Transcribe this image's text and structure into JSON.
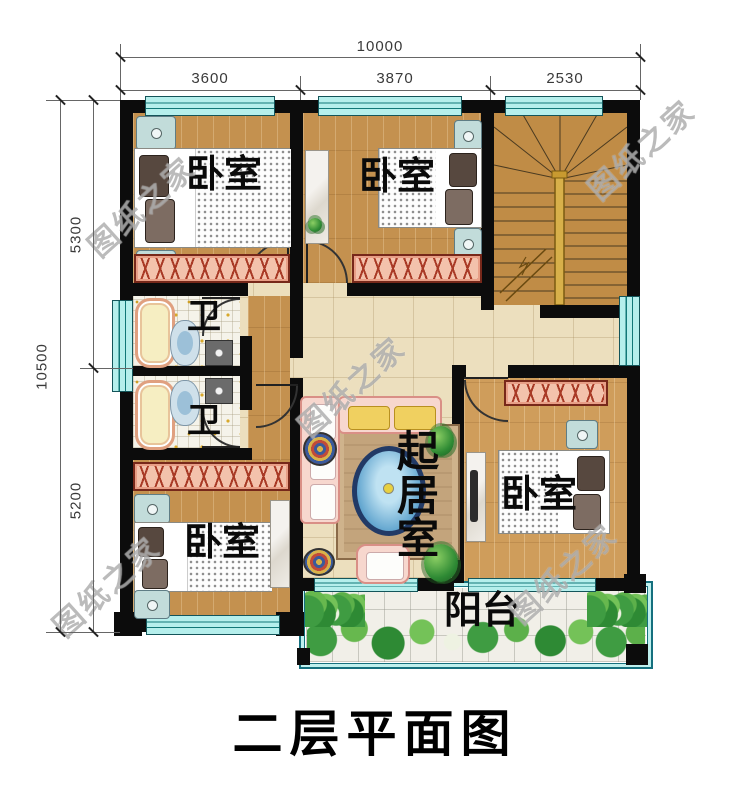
{
  "title": "二层平面图",
  "watermark": "图纸之家",
  "dimensions": {
    "top_total": "10000",
    "top_segments": [
      "3600",
      "3870",
      "2530"
    ],
    "left_total": "10500",
    "left_segments": [
      "5300",
      "5200"
    ]
  },
  "rooms": {
    "bedroom_top_left": "卧室",
    "bedroom_top_mid": "卧室",
    "bedroom_bottom_left": "卧室",
    "bedroom_bottom_right": "卧室",
    "bath_top": "卫",
    "bath_bottom": "卫",
    "living": "起居室",
    "balcony": "阳台"
  },
  "colors": {
    "wall": "#0c0c0c",
    "wood_floor": "#c4914f",
    "hall_tile": "#ecdfbe",
    "window": "#b5efec",
    "wardrobe": "#f3c2ac",
    "plants": "#3f9c42"
  }
}
